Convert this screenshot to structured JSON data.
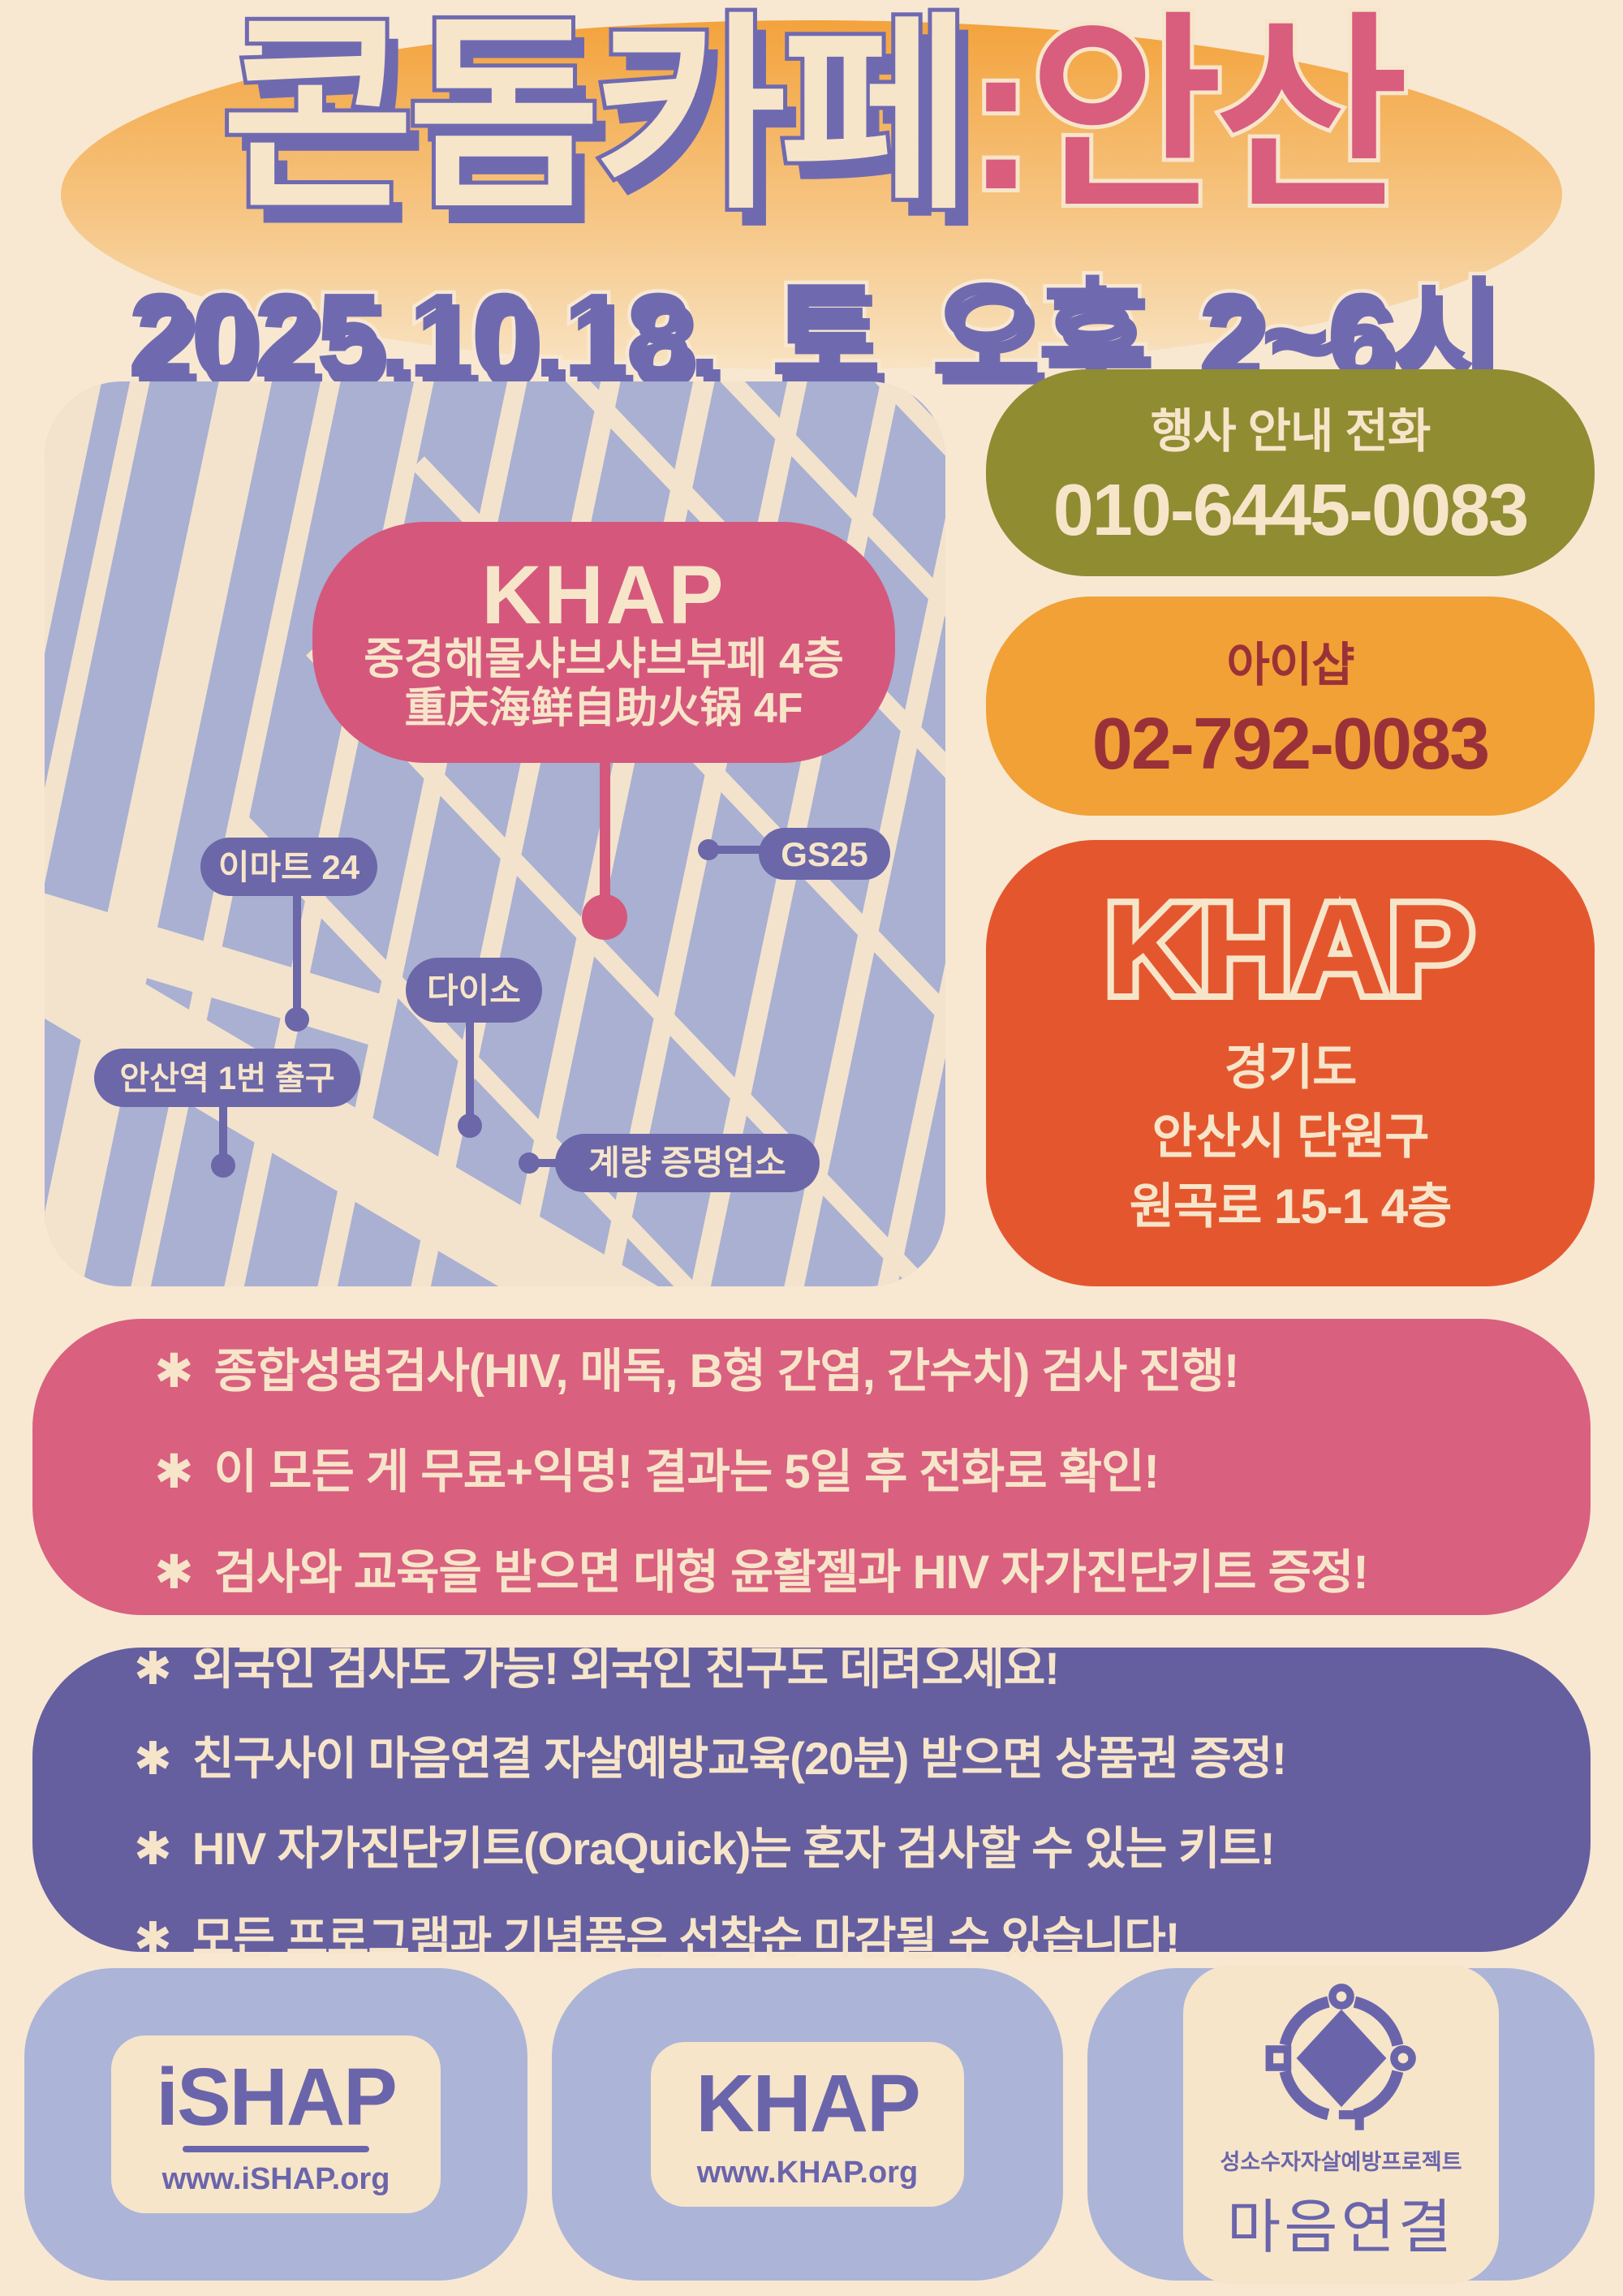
{
  "poster": {
    "title": {
      "main": "콘돔카페",
      "suffix": ":안산"
    },
    "date": "2025.10.18. 토 오후 2~6시",
    "map": {
      "callout": {
        "name": "KHAP",
        "line1": "중경해물샤브샤브부페 4층",
        "line2": "重庆海鲜自助火锅 4F"
      },
      "labels": {
        "emart": "이마트 24",
        "gs25": "GS25",
        "daiso": "다이소",
        "station": "안산역 1번 출구",
        "measure": "계량 증명업소"
      }
    },
    "event_phone": {
      "label": "행사 안내 전화",
      "number": "010-6445-0083"
    },
    "ishap_phone": {
      "label": "아이샵",
      "number": "02-792-0083"
    },
    "venue": {
      "name": "KHAP",
      "address_lines": [
        "경기도",
        "안산시 단원구",
        "원곡로 15-1 4층"
      ]
    },
    "bullet": "✱",
    "services": [
      "종합성병검사(HIV, 매독, B형 간염, 간수치) 검사 진행!",
      "이 모든 게 무료+익명! 결과는 5일 후 전화로 확인!",
      "검사와 교육을 받으면 대형 윤활젤과 HIV 자가진단키트 증정!"
    ],
    "notices": [
      "외국인 검사도 가능! 외국인 친구도 데려오세요!",
      "친구사이 마음연결 자살예방교육(20분) 받으면 상품권 증정!",
      "HIV 자가진단키트(OraQuick)는 혼자 검사할 수 있는 키트!",
      "모든 프로그램과 기념품은 선착순 마감될 수 있습니다!"
    ],
    "footer": {
      "ishap": {
        "name": "iSHAP",
        "url": "www.iSHAP.org"
      },
      "khap": {
        "name": "KHAP",
        "url": "www.KHAP.org"
      },
      "maum": {
        "project": "성소수자자살예방프로젝트",
        "name": "마음연결"
      }
    },
    "colors": {
      "background": "#f8e8d2",
      "title_purple": "#6f6ab0",
      "title_pink": "#d95d7d",
      "header_glow_orange": "#f3a33c",
      "olive_box": "#8f8c32",
      "orange_box": "#f1a136",
      "maroon_text": "#9b3138",
      "red_orange_box": "#e4572e",
      "pink_box": "#d9607f",
      "purple_box": "#655fa0",
      "map_background": "#a9b0d2",
      "map_road_cream": "#f3e3cd",
      "map_pill_purple": "#6b67a8",
      "map_callout_pink": "#d5587c",
      "footer_box_blue": "#acb5d8",
      "cream": "#f7e5ca",
      "logo_purple": "#6a65ab"
    }
  }
}
